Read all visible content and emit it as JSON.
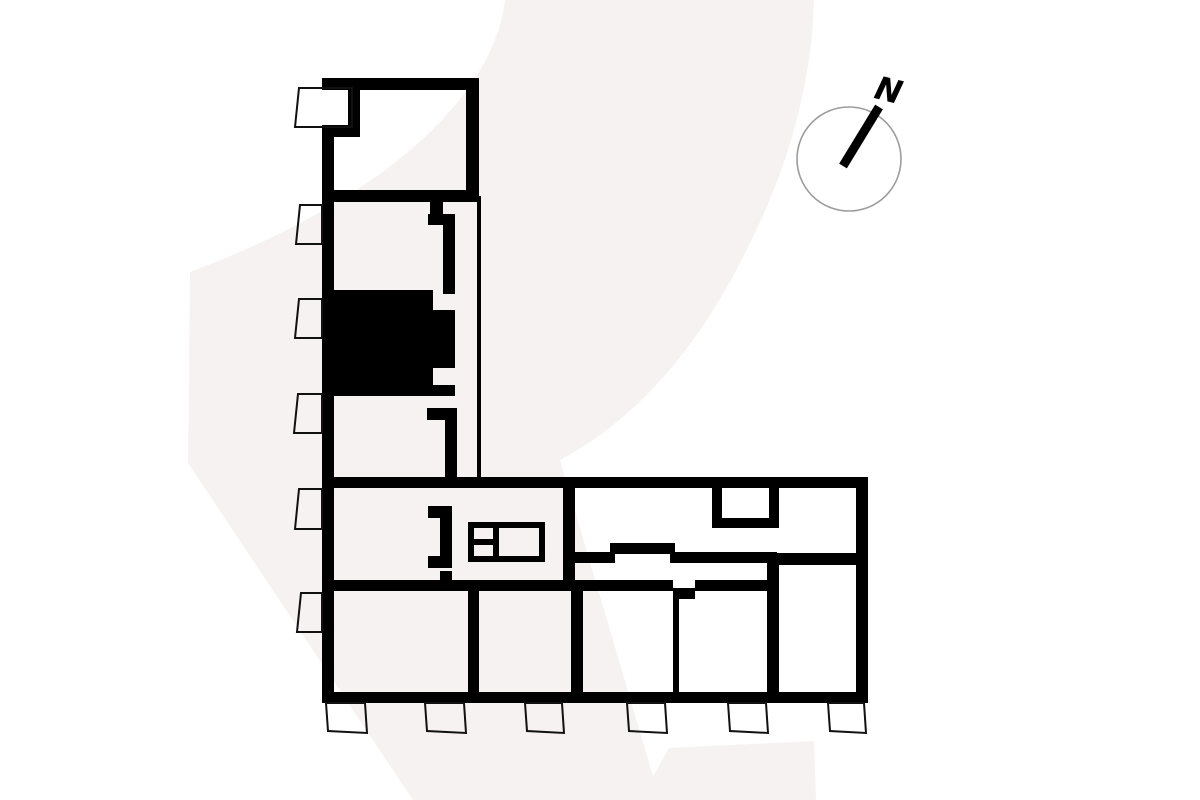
{
  "meta": {
    "view": "floor-plan-level-overview",
    "canvas": {
      "width": 1200,
      "height": 800
    }
  },
  "colors": {
    "background": "#ffffff",
    "wall": "#000000",
    "highlighted_unit": "#000000",
    "watermark": "#f6f2f1",
    "compass_ring": "#9c9c9c",
    "compass_needle": "#000000",
    "balcony_line": "#111111"
  },
  "compass": {
    "label": "N",
    "center_x": 849,
    "center_y": 159,
    "radius": 52,
    "ring_width": 1.6,
    "needle": {
      "x1": 843,
      "y1": 166,
      "x2": 879,
      "y2": 107,
      "width": 9
    },
    "label_x": 886,
    "label_y": 101,
    "label_size": 32,
    "label_rotation": 14
  },
  "watermark": {
    "glyph": "2",
    "paths": [
      "M 505,0 C 495,90 395,195 190,272 L 188,463 L 413,800 L 660,800 L 560,460 C 645,415 706,334 748,247 C 789,166 812,82 814,0 Z",
      "M 640,800 L 669,748 L 814,741 L 816,800 Z"
    ]
  },
  "plan": {
    "walls": [
      [
        322,
        78,
        157,
        12
      ],
      [
        348,
        90,
        12,
        47
      ],
      [
        322,
        125,
        38,
        12
      ],
      [
        322,
        125,
        12,
        578
      ],
      [
        466,
        78,
        13,
        124
      ],
      [
        322,
        190,
        157,
        12
      ],
      [
        430,
        202,
        13,
        22
      ],
      [
        428,
        214,
        27,
        11
      ],
      [
        443,
        214,
        12,
        80
      ],
      [
        322,
        385,
        133,
        11
      ],
      [
        427,
        408,
        30,
        12
      ],
      [
        445,
        408,
        12,
        70
      ],
      [
        322,
        477,
        546,
        11
      ],
      [
        428,
        506,
        24,
        12
      ],
      [
        440,
        518,
        12,
        40
      ],
      [
        428,
        556,
        24,
        12
      ],
      [
        440,
        571,
        12,
        11
      ],
      [
        322,
        580,
        351,
        11
      ],
      [
        695,
        580,
        77,
        11
      ],
      [
        673,
        588,
        22,
        11
      ],
      [
        563,
        488,
        12,
        92
      ],
      [
        575,
        552,
        40,
        11
      ],
      [
        610,
        543,
        65,
        11
      ],
      [
        670,
        552,
        107,
        11
      ],
      [
        772,
        553,
        96,
        12
      ],
      [
        712,
        488,
        10,
        40
      ],
      [
        769,
        488,
        10,
        40
      ],
      [
        712,
        518,
        67,
        10
      ],
      [
        767,
        554,
        12,
        149
      ],
      [
        856,
        477,
        12,
        226
      ],
      [
        322,
        692,
        546,
        11
      ],
      [
        468,
        591,
        11,
        101
      ],
      [
        571,
        591,
        12,
        101
      ],
      [
        673,
        599,
        6,
        93
      ]
    ],
    "thin_walls": [
      [
        477,
        196,
        4,
        284
      ]
    ],
    "highlighted_unit_path": "M322,290 L433,290 L433,310 L455,310 L455,368 L433,368 L433,385 L322,385 Z",
    "balconies": [
      "299,88 352,88 352,127 295,127",
      "300,205 322,205 322,244 296,244",
      "299,299 322,299 322,338 295,338",
      "298,394 322,394 322,433 294,433",
      "299,489 322,489 322,529 295,529",
      "301,593 322,593 322,632 297,632",
      "326,703 365,703 367,733 328,731",
      "425,703 464,703 466,733 427,731",
      "525,703 562,703 564,733 527,731",
      "627,703 665,703 667,733 629,731",
      "728,703 766,703 768,733 730,731",
      "828,703 864,703 866,733 830,731"
    ],
    "balcony_line_width": 2,
    "elevator": {
      "outer": [
        471,
        525,
        71,
        34
      ],
      "divider_x": 496,
      "left_cell_split_y": 542,
      "line_width": 6
    }
  }
}
